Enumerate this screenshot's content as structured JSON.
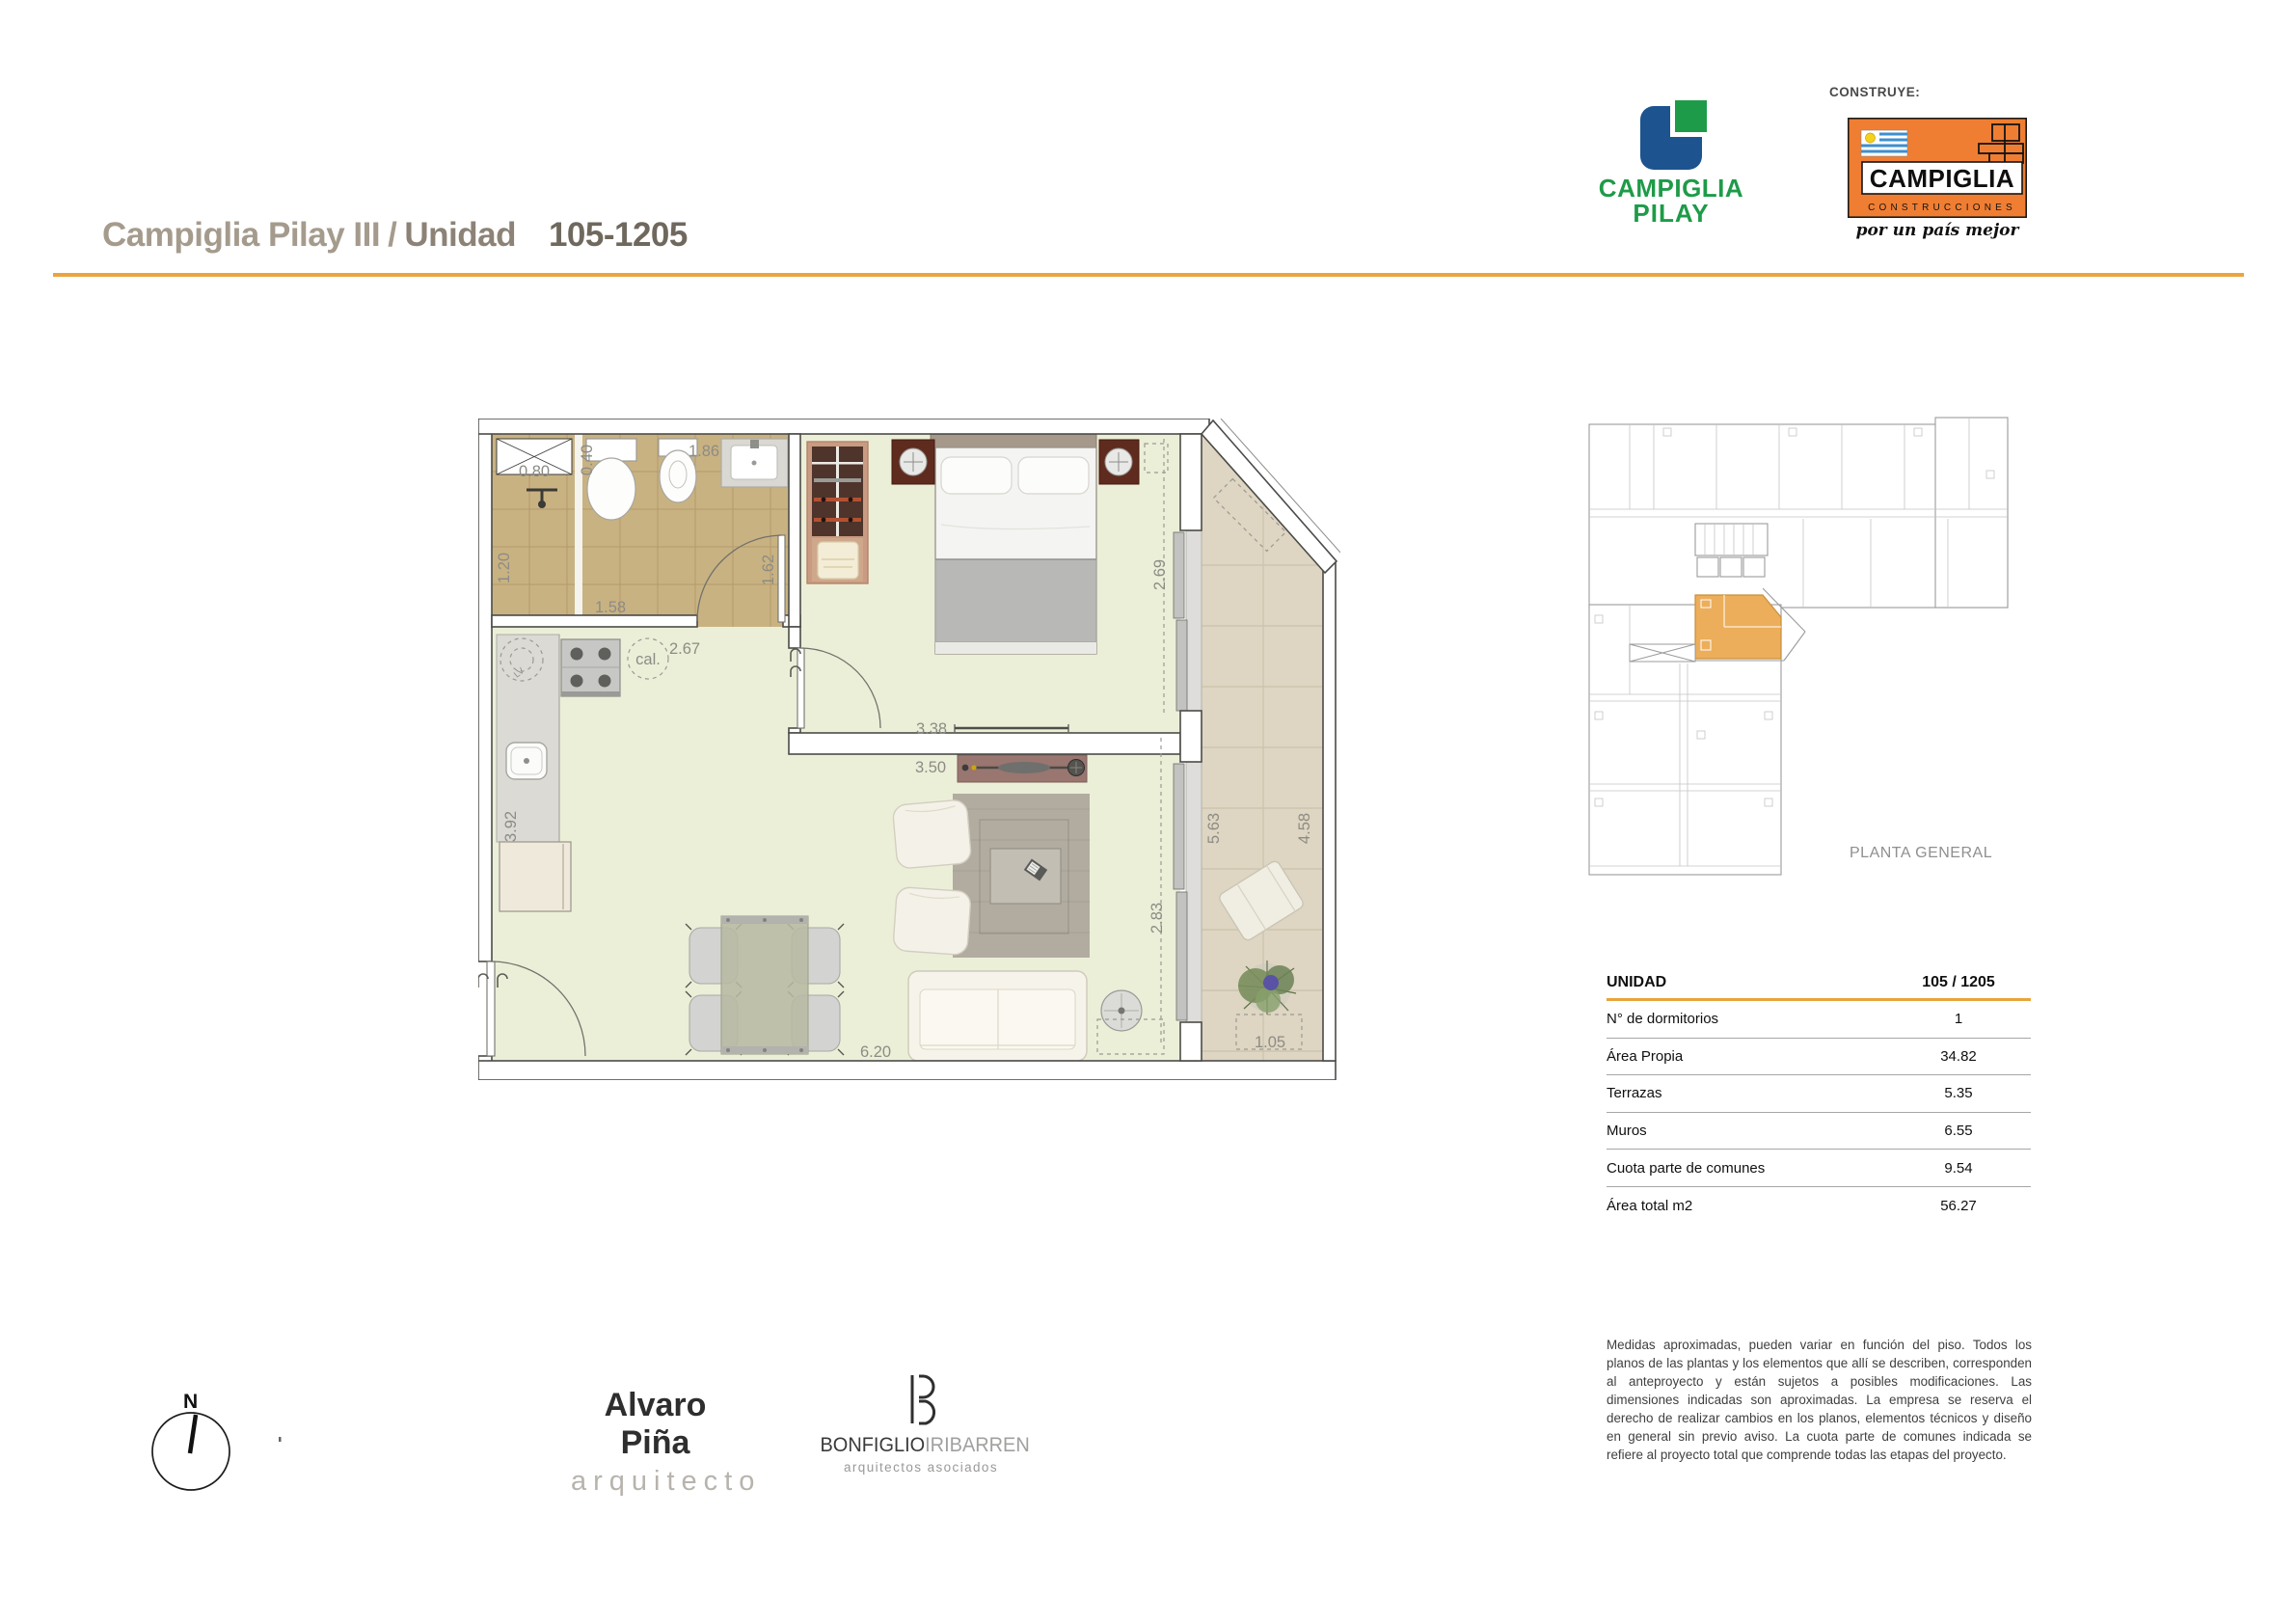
{
  "header": {
    "project_title": "Campiglia Pilay III",
    "divider": "/",
    "unit_word": "Unidad",
    "unit_code": "105-1205"
  },
  "logos": {
    "pilay": {
      "line1": "CAMPIGLIA",
      "line2": "PILAY"
    },
    "construye_label": "CONSTRUYE:",
    "construcciones": {
      "name": "CAMPIGLIA",
      "sub": "CONSTRUCCIONES",
      "tagline": "por un país mejor"
    }
  },
  "floor_plan": {
    "dims": [
      {
        "text": "0.80"
      },
      {
        "text": "0.40"
      },
      {
        "text": "1.86"
      },
      {
        "text": "1.20"
      },
      {
        "text": "1.58"
      },
      {
        "text": "1.62"
      },
      {
        "text": "2.67"
      },
      {
        "text": "3.92"
      },
      {
        "text": "3.38"
      },
      {
        "text": "3.50"
      },
      {
        "text": "2.69"
      },
      {
        "text": "2.83"
      },
      {
        "text": "5.63"
      },
      {
        "text": "4.58"
      },
      {
        "text": "6.20"
      },
      {
        "text": "1.05"
      }
    ],
    "room_labels": {
      "cal": "cal.",
      "lv": "LV"
    }
  },
  "overview": {
    "caption": "PLANTA GENERAL"
  },
  "unit_table": {
    "title": "UNIDAD",
    "title_value": "105 / 1205",
    "rows": [
      {
        "label": "N° de dormitorios",
        "value": "1"
      },
      {
        "label": "Área Propia",
        "value": "34.82"
      },
      {
        "label": "Terrazas",
        "value": "5.35"
      },
      {
        "label": "Muros",
        "value": "6.55"
      },
      {
        "label": "Cuota parte de comunes",
        "value": "9.54"
      },
      {
        "label": "Área total m2",
        "value": "56.27"
      }
    ]
  },
  "disclaimer": "Medidas aproximadas, pueden variar en función del piso. Todos los planos de las plantas y los elementos que allí se describen, corresponden al anteproyecto y están sujetos a posibles modificaciones. Las dimensiones indicadas son aproximadas. La empresa se reserva el derecho de realizar cambios en los planos, elementos técnicos y diseño en general sin previo aviso. La cuota parte de comunes indicada se refiere al proyecto total que comprende todas las etapas del proyecto.",
  "compass": {
    "north": "N"
  },
  "signatures": {
    "architect_name": "Alvaro Piña",
    "architect_title": "arquitecto",
    "studio_dark": "BONFIGLIO",
    "studio_light": "IRIBARREN",
    "studio_sub": "arquitectos asociados"
  },
  "colors": {
    "accent_orange": "#EBA440",
    "logo_orange": "#EF7E33",
    "pilay_green": "#1E9B48",
    "pilay_blue": "#1D538F",
    "unit_highlight": "#ECAE5B"
  }
}
